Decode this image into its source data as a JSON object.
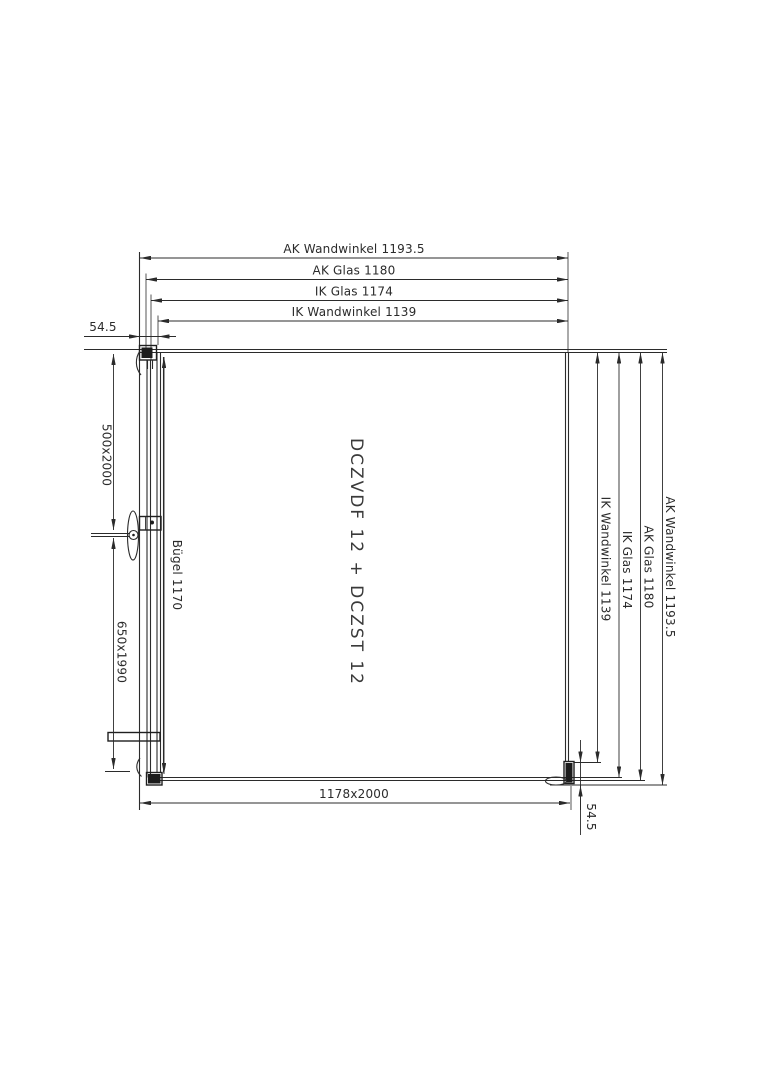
{
  "colors": {
    "line": "#2b2b2b",
    "dark_fill": "#1c1c1c",
    "background": "#ffffff"
  },
  "drawing": {
    "product_code": "DCZVDF 12 + DCZST 12",
    "top_dimensions": [
      "AK Wandwinkel 1193.5",
      "AK Glas 1180",
      "IK Glas 1174",
      "IK Wandwinkel 1139"
    ],
    "right_dimensions": [
      "IK Wandwinkel 1139",
      "IK Glas 1174",
      "AK Glas 1180",
      "AK Wandwinkel 1193.5"
    ],
    "wall_offset_top_left": "54.5",
    "wall_offset_bottom_right": "54.5",
    "glass_size_upper": "500x2000",
    "glass_size_lower": "650x1990",
    "bar_label": "Bügel 1170",
    "overall_size": "1178x2000"
  }
}
